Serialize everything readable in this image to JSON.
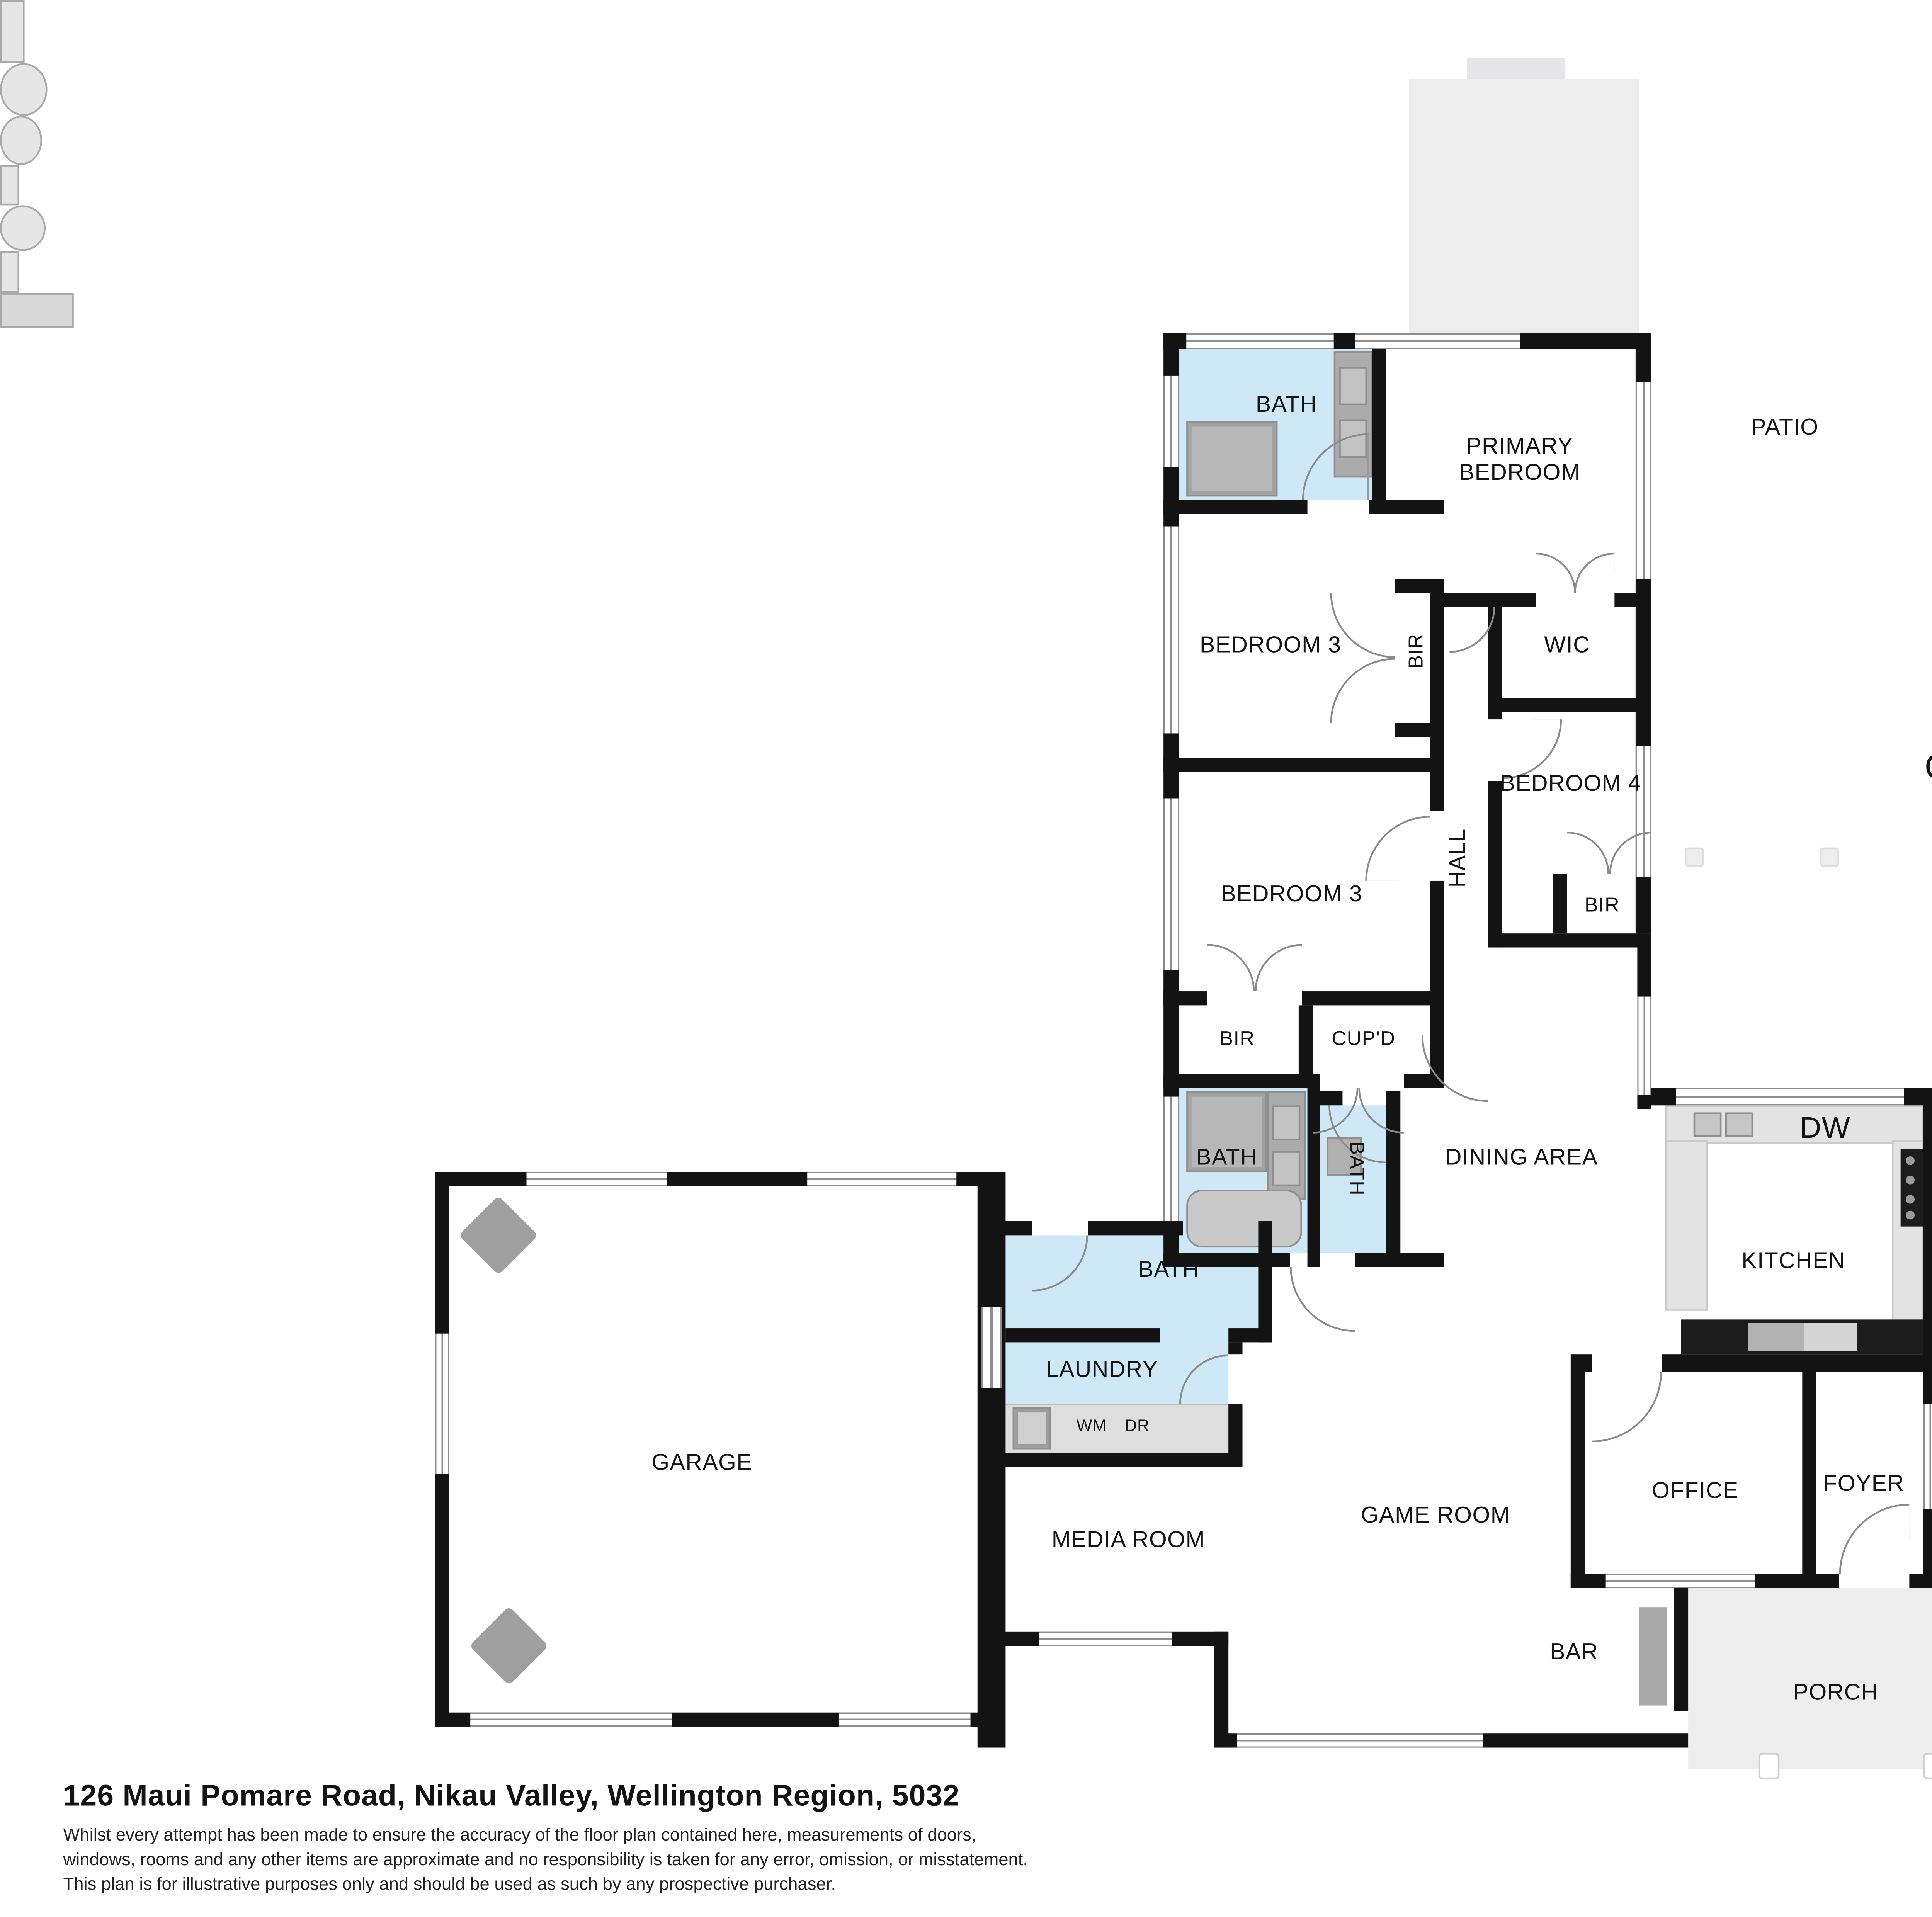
{
  "compass": {
    "north": "N"
  },
  "rooms": {
    "patio": "PATIO",
    "covered_patio": "COVERED PATIO",
    "primary_bedroom": "PRIMARY\nBEDROOM",
    "ensuite_bath": "BATH",
    "bedroom3_upper": "BEDROOM 3",
    "bir_upper": "BIR",
    "wic": "WIC",
    "bedroom4": "BEDROOM 4",
    "bir_bedroom4": "BIR",
    "hall": "HALL",
    "bedroom3_lower": "BEDROOM 3",
    "bir_lower": "BIR",
    "cupboard": "CUP'D",
    "bath_main": "BATH",
    "bath_small": "BATH",
    "dining": "DINING AREA",
    "dishwasher": "DW",
    "kitchen": "KITCHEN",
    "fp_outdoor": "FP",
    "fp_living": "FP",
    "living": "LIVING ROOM",
    "bath_guest": "BATH",
    "laundry": "LAUNDRY",
    "washing_machine": "WM",
    "dryer": "DR",
    "garage": "GARAGE",
    "media": "MEDIA ROOM",
    "game": "GAME ROOM",
    "bar": "BAR",
    "office": "OFFICE",
    "foyer": "FOYER",
    "porch": "PORCH"
  },
  "footer": {
    "address": "126 Maui Pomare Road, Nikau Valley, Wellington Region, 5032",
    "disclaimer": [
      "Whilst every attempt has been made to ensure the accuracy of the floor plan contained here, measurements of doors,",
      "windows, rooms and any other items are approximate and no responsibility is taken for any error, omission, or misstatement.",
      "This plan is for illustrative purposes only and should be used as such by any prospective purchaser."
    ]
  },
  "colors": {
    "wall": "#131313",
    "bath_fill": "#cfe8f8",
    "patio_fill": "#ededee",
    "fixture_gray": "#b7b7b7"
  }
}
